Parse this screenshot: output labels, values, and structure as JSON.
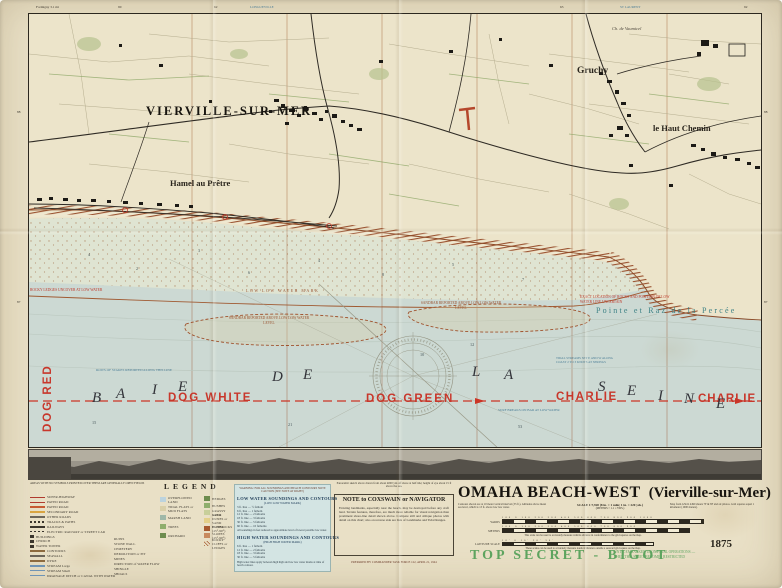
{
  "colors": {
    "paper": "#e9e0c6",
    "water": "#ccd9d3",
    "tidal_flat": "#dfe4d2",
    "cliff_hatch": "#9a5230",
    "sector_red": "#c8372b",
    "classification_green": "#5ea45f",
    "soundings_panel_blue": "#d3e4e3",
    "pointe_teal": "#3e8286"
  },
  "margin": {
    "top": [
      "Formigny 3.1 mi",
      "90",
      "62",
      "LONGUEVILLE",
      "63",
      "ST LAURENT",
      "92"
    ],
    "left": [
      "88",
      "87"
    ],
    "right": [
      "88",
      "87"
    ]
  },
  "map": {
    "places": {
      "vierville": "VIERVILLE-SUR-MER",
      "hamel": "Hamel au Prêtre",
      "gruchy": "Gruchy",
      "haut_chemin": "le Haut Chemin",
      "chateau": "Ch. de Vaumicel",
      "pointe": "Pointe et Raz de la Percée"
    },
    "sectors": [
      "DOG RED",
      "DOG WHITE",
      "DOG GREEN",
      "CHARLIE",
      "CHARLIE"
    ],
    "sea_name_letters": [
      "B",
      "A",
      "I",
      "E",
      "D",
      "E",
      "L",
      "A",
      "S",
      "E",
      "I",
      "N",
      "E"
    ],
    "water_notes": {
      "llw": "LOW LOW WATER MARK",
      "sandbar1": "SANDBAR REPORTED ABOVE LOW LOW WATER LEVEL",
      "sandbar2": "SANDBAR REPORTED ABOVE LOW LOW WATER LEVEL",
      "rocks_note": "EXACT LOCATION OF ROCKS AND POSITION OF LOW WATER LINE UNCERTAIN",
      "ledge_note": "ROCKY LEDGES UNCOVER AT LOW WATER",
      "stakes_note": "ROWS OF STAKES REPORTED ALONG THIS LINE",
      "current_note": "TIDAL STREAMS SET E AND W ALONG COAST 2 TO 3 KNOTS AT SPRINGS",
      "surf_note": "SURF BREAKS ON BAR AT LOW WATER"
    },
    "depths": [
      "4",
      "2",
      "3",
      "6",
      "4",
      "8",
      "5",
      "7",
      "10",
      "12",
      "53",
      "21",
      "15"
    ]
  },
  "legend": {
    "header": "AREAS WITH NO SYMBOLS PRINTED OVER THEM ARE GENERALLY OPEN FIELDS",
    "title": "LEGEND",
    "colA": [
      "SUPER-HIGHWAY",
      "PAVED ROAD",
      "PAVED ROAD",
      "SECONDARY ROAD",
      "OTHER ROADS",
      "TRACKS & PATHS",
      "RAILWAYS",
      "ELECTRIC RAILWAY or STREET CAR",
      "BUILDINGS",
      "CHURCH",
      "WATER TOWER",
      "CONTOURS",
      "SEAWALL",
      "DYKE",
      "STREAM Large",
      "STREAM Small",
      "DRAINAGE DITCH or CANAL WITH WATER"
    ],
    "colB": [
      "RUINS",
      "STONE WALL",
      "CEMETERY",
      "DEMOLITION or PIT",
      "MINES",
      "DIRECTION of WATER FLOW",
      "SHINGLE",
      "SHOALS"
    ],
    "colC": [
      "OVERFLOWED LAND",
      "TIDAL FLATS or MUD FLATS",
      "MARSH LAND",
      "TREES",
      "ORCHARD"
    ],
    "colD": [
      "HEDGES",
      "BUSHES",
      "GRASSY AREA",
      "SAND DUNES or SAND HUMMOCKS",
      "CLIFFS (45°-90°)",
      "SLOPES (45°-90°)",
      "ROCKY CLIFFS or LEDGES"
    ]
  },
  "soundings": {
    "warning": "WARNING: FOR ALL SOUNDINGS AND BEACH CONTOURS NOTE CAUTION (SEE NOTE AT RIGHT)",
    "low_title": "LOW WATER SOUNDINGS AND CONTOURS",
    "low_sub": "(LOW LOW WATER MARK)",
    "low_rows": [
      "3 ft. line — ½ fathom",
      "6 ft. line — 1 fathom",
      "12 ft. line — 2 fathoms",
      "18 ft. line — 3 fathoms",
      "30 ft. line — 5 fathoms",
      "60 ft. line — 10 fathoms"
    ],
    "low_note": "All soundings in feet reduced to approximate level of lowest possible low water.",
    "high_title": "HIGH WATER SOUNDINGS AND CONTOURS",
    "high_sub": "(HIGH HIGH WATER MARK)",
    "high_rows": [
      "6 ft. line — 1 fathom",
      "12 ft. line — 2 fathoms",
      "18 ft. line — 3 fathoms",
      "30 ft. line — 5 fathoms"
    ],
    "high_note": "High water lines apply between high high and low low water marks at time of beach contour."
  },
  "note_panel": {
    "caption": "Panoramic sketch above drawn from about 4000 yds off shore at half tide; height of eye about 15 ft above the sea.",
    "title": "NOTE to COXSWAIN or NAVIGATOR",
    "body": "Existing landmarks, especially near the beach, may be destroyed before any craft land. Terrain features, therefore, are much more reliable for visual navigation than prominent shore-line detail shown above. Compare still and oblique photos with detail on this chart; also on reverse side are lists of Landmarks and Tidal Ranges.",
    "footer": "PREPARED BY COMMANDER TASK FORCE 122, APRIL 21, 1944"
  },
  "title_block": {
    "title": "OMAHA BEACH-WEST",
    "subtitle": "(Vierville-sur-Mer)",
    "note_left": "Contours shown are at 10 meter vertical interval (33 ft.). Altitudes above mean sea level, which is 13 ft. above low low water.",
    "scale": "SCALE 1:7,920 (8 in. = 1 mile; 1 in. = 220 yds.)",
    "scale_sub": "(METERS × 1.1 = YDS.)",
    "note_right": "Map from GSGS 4490 sheets 7F & 8F and air photos. Grid squares equal 1 kilometer (1000 meters).",
    "bars": [
      {
        "label": "YARDS",
        "ticks": "100 0 100 200 300 400 500 600 700 800 900 1000"
      },
      {
        "label": "METERS",
        "ticks": "100 0 100 200 300 400 500 600 700 800 900"
      },
      {
        "label": "LATITUDE SCALE",
        "ticks": "10' 0 10' 20' 30'"
      }
    ],
    "bar_note1": "This scale can be used to accurately measure vehicle advance in conformance to the grid squares on the map.",
    "bar_note2": "These scales can be used to accurately measure nautical distance outside a seaward grid square on the map.",
    "sheet_number": "1875"
  },
  "classification": {
    "stamp": "TOP SECRET - BIGOT",
    "note1": "UNTIL EMBARKED UPON FINAL OPERATIONS —",
    "note2": "THEN THIS SHEET BECOMES RESTRICTED"
  }
}
